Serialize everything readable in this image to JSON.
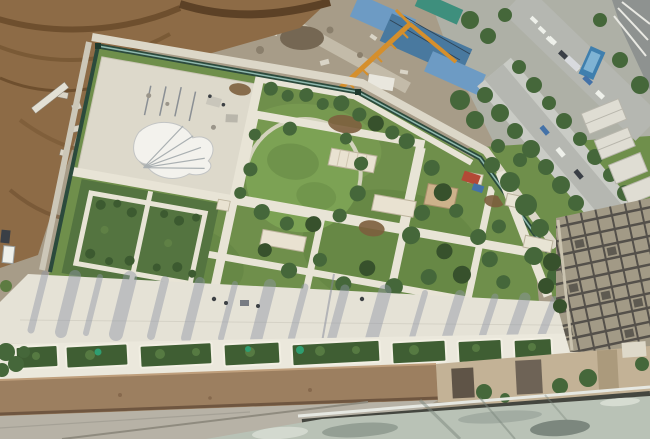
{
  "image": {
    "width": 650,
    "height": 439,
    "title": "Aerial photograph looking down from a high-rise onto a landscaped podium garden beside an active construction site, city streets and neighbouring towers"
  },
  "palette": {
    "ground": "#a79c88",
    "urban": "#aeb0a6",
    "dirt": "#8d6b46",
    "dirt_dark": "#6b4c2d",
    "debris": "#d9d4c6",
    "lawn": "#6f8f4b",
    "lawn_light": "#7ca254",
    "foliage": "#45673a",
    "foliage_dark": "#37512c",
    "hedge": "#547440",
    "bed_green": "#3f5e33",
    "teal_shrub": "#2f9e71",
    "fence": "#2b4a3c",
    "fence_glass": "#8fb8ae",
    "path": "#e8e4d6",
    "plaza": "#ddd9cb",
    "promenade": "#e5e2d6",
    "shadow_blue": "#8f96a6",
    "mulch": "#7d5f3e",
    "parapet": "#9c7f60",
    "parapet_dark": "#6f5640",
    "ledge": "#b7b2a6",
    "glass": "#b9c2b6",
    "rail": "#44463f",
    "facade": "#a29a86",
    "facade_dark": "#54504a",
    "terrace": "#c3b296",
    "tarp_blue": "#6d9bc4",
    "tarp_blue_dark": "#49799f",
    "teal": "#3e8f7d",
    "crane": "#d58f2c",
    "road": "#b5b7b1",
    "road_light": "#c9cbc5",
    "white_roof": "#dfddd3",
    "building_gray": "#8e9290",
    "car_white": "#eef0ea",
    "car_dark": "#3a3f46",
    "car_blue": "#4472a8",
    "red_equipment": "#b34a36",
    "water_blue": "#3f7fae",
    "people": "#3c4044"
  },
  "scene": {
    "regions": [
      {
        "name": "excavation-dirt",
        "label": "brown excavated earth with rubble, upper left"
      },
      {
        "name": "construction-ground",
        "label": "graded construction ground with debris and dirt road, top centre"
      },
      {
        "name": "tower-crane",
        "label": "orange tower crane boom over the site"
      },
      {
        "name": "tarp-buildings",
        "label": "blue tarpaulin covered site buildings"
      },
      {
        "name": "city-streets",
        "label": "tree-lined streets with cars, upper right"
      },
      {
        "name": "podium-garden",
        "label": "fenced landscaped garden with lawns, white paths, hedges and young trees"
      },
      {
        "name": "white-plaza",
        "label": "paved plaza with white canopy sculpture and scaffold"
      },
      {
        "name": "promenade",
        "label": "wide light concrete promenade streaked with tree shadows"
      },
      {
        "name": "planter-beds",
        "label": "row of rectangular shrub planters along the promenade"
      },
      {
        "name": "parapet",
        "label": "tan parapet wall of the foreground building"
      },
      {
        "name": "glass-canopy",
        "label": "reflective glass canopy and dark handrail in the foreground"
      },
      {
        "name": "tower-facade",
        "label": "gridded facade of neighbouring high-rise, lower right"
      }
    ]
  }
}
